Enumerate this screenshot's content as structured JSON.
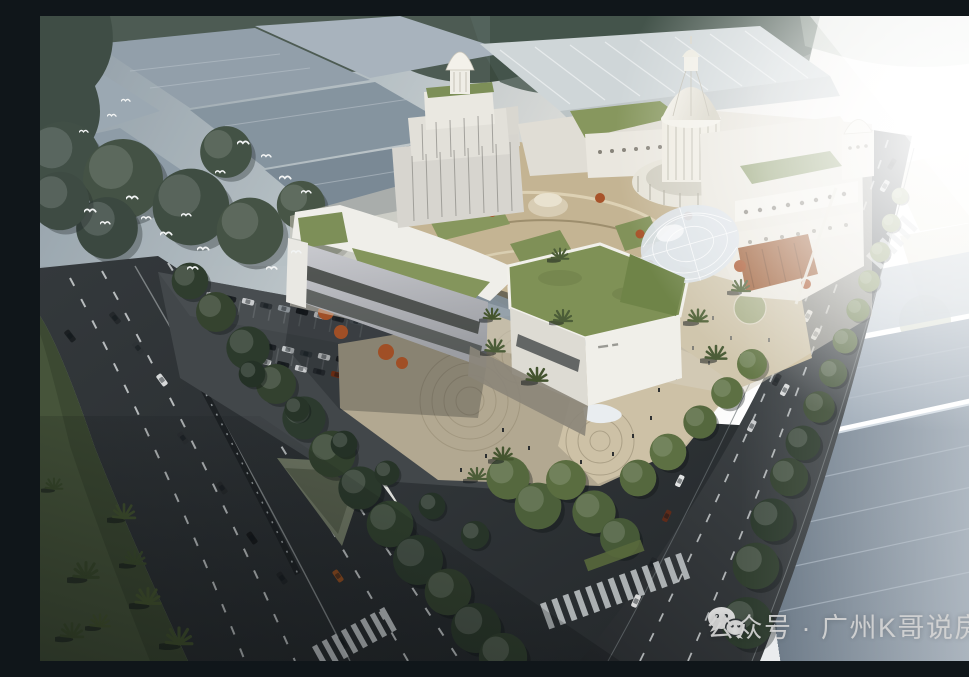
{
  "watermark": {
    "icon": "wechat",
    "text": "公众号 · 广州K哥说房",
    "text_color": "#d4d4d4"
  },
  "palette": {
    "sky_haze": "#aeb8bd",
    "sun_glare": "#ffffff",
    "warehouse_roof_blue_gray": "#8593a0",
    "bottom_right_roof": "#8795a3",
    "tree_dark": "#2c3a2c",
    "tree_lit": "#6d7e50",
    "mall_facade_white": "#efeee9",
    "green_roof": "#7f9156",
    "courtyard_tan": "#c4b493",
    "plaza_paving": "#cfc3a8",
    "autumn_tree_orange": "#a8532a",
    "asphalt_dark": "#303538",
    "lane_marking": "#d8dcdd"
  }
}
